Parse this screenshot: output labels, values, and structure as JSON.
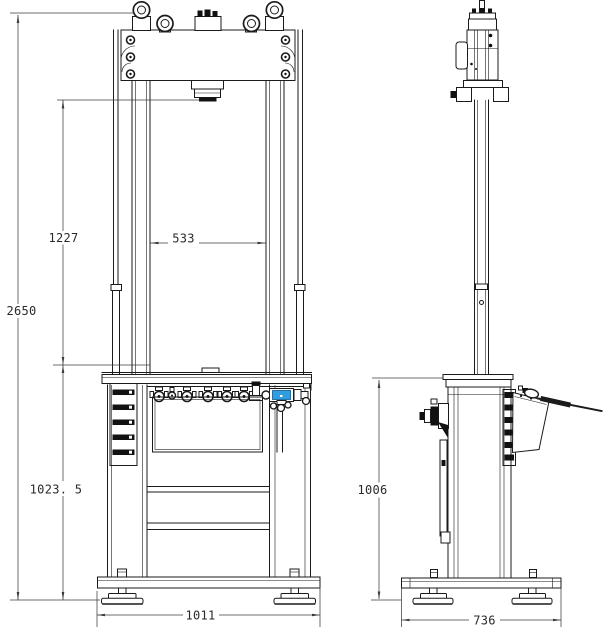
{
  "drawing": {
    "accent_color": "#2f9de2",
    "line_color": "#1b1b1b",
    "dim_color": "#3c3c3c",
    "dimensions": {
      "overall_height": "2650",
      "ram_to_table": "1227",
      "between_columns": "533",
      "floor_to_table_front": "1023. 5",
      "base_width": "1011",
      "floor_to_table_side": "1006",
      "base_depth": "736"
    }
  }
}
